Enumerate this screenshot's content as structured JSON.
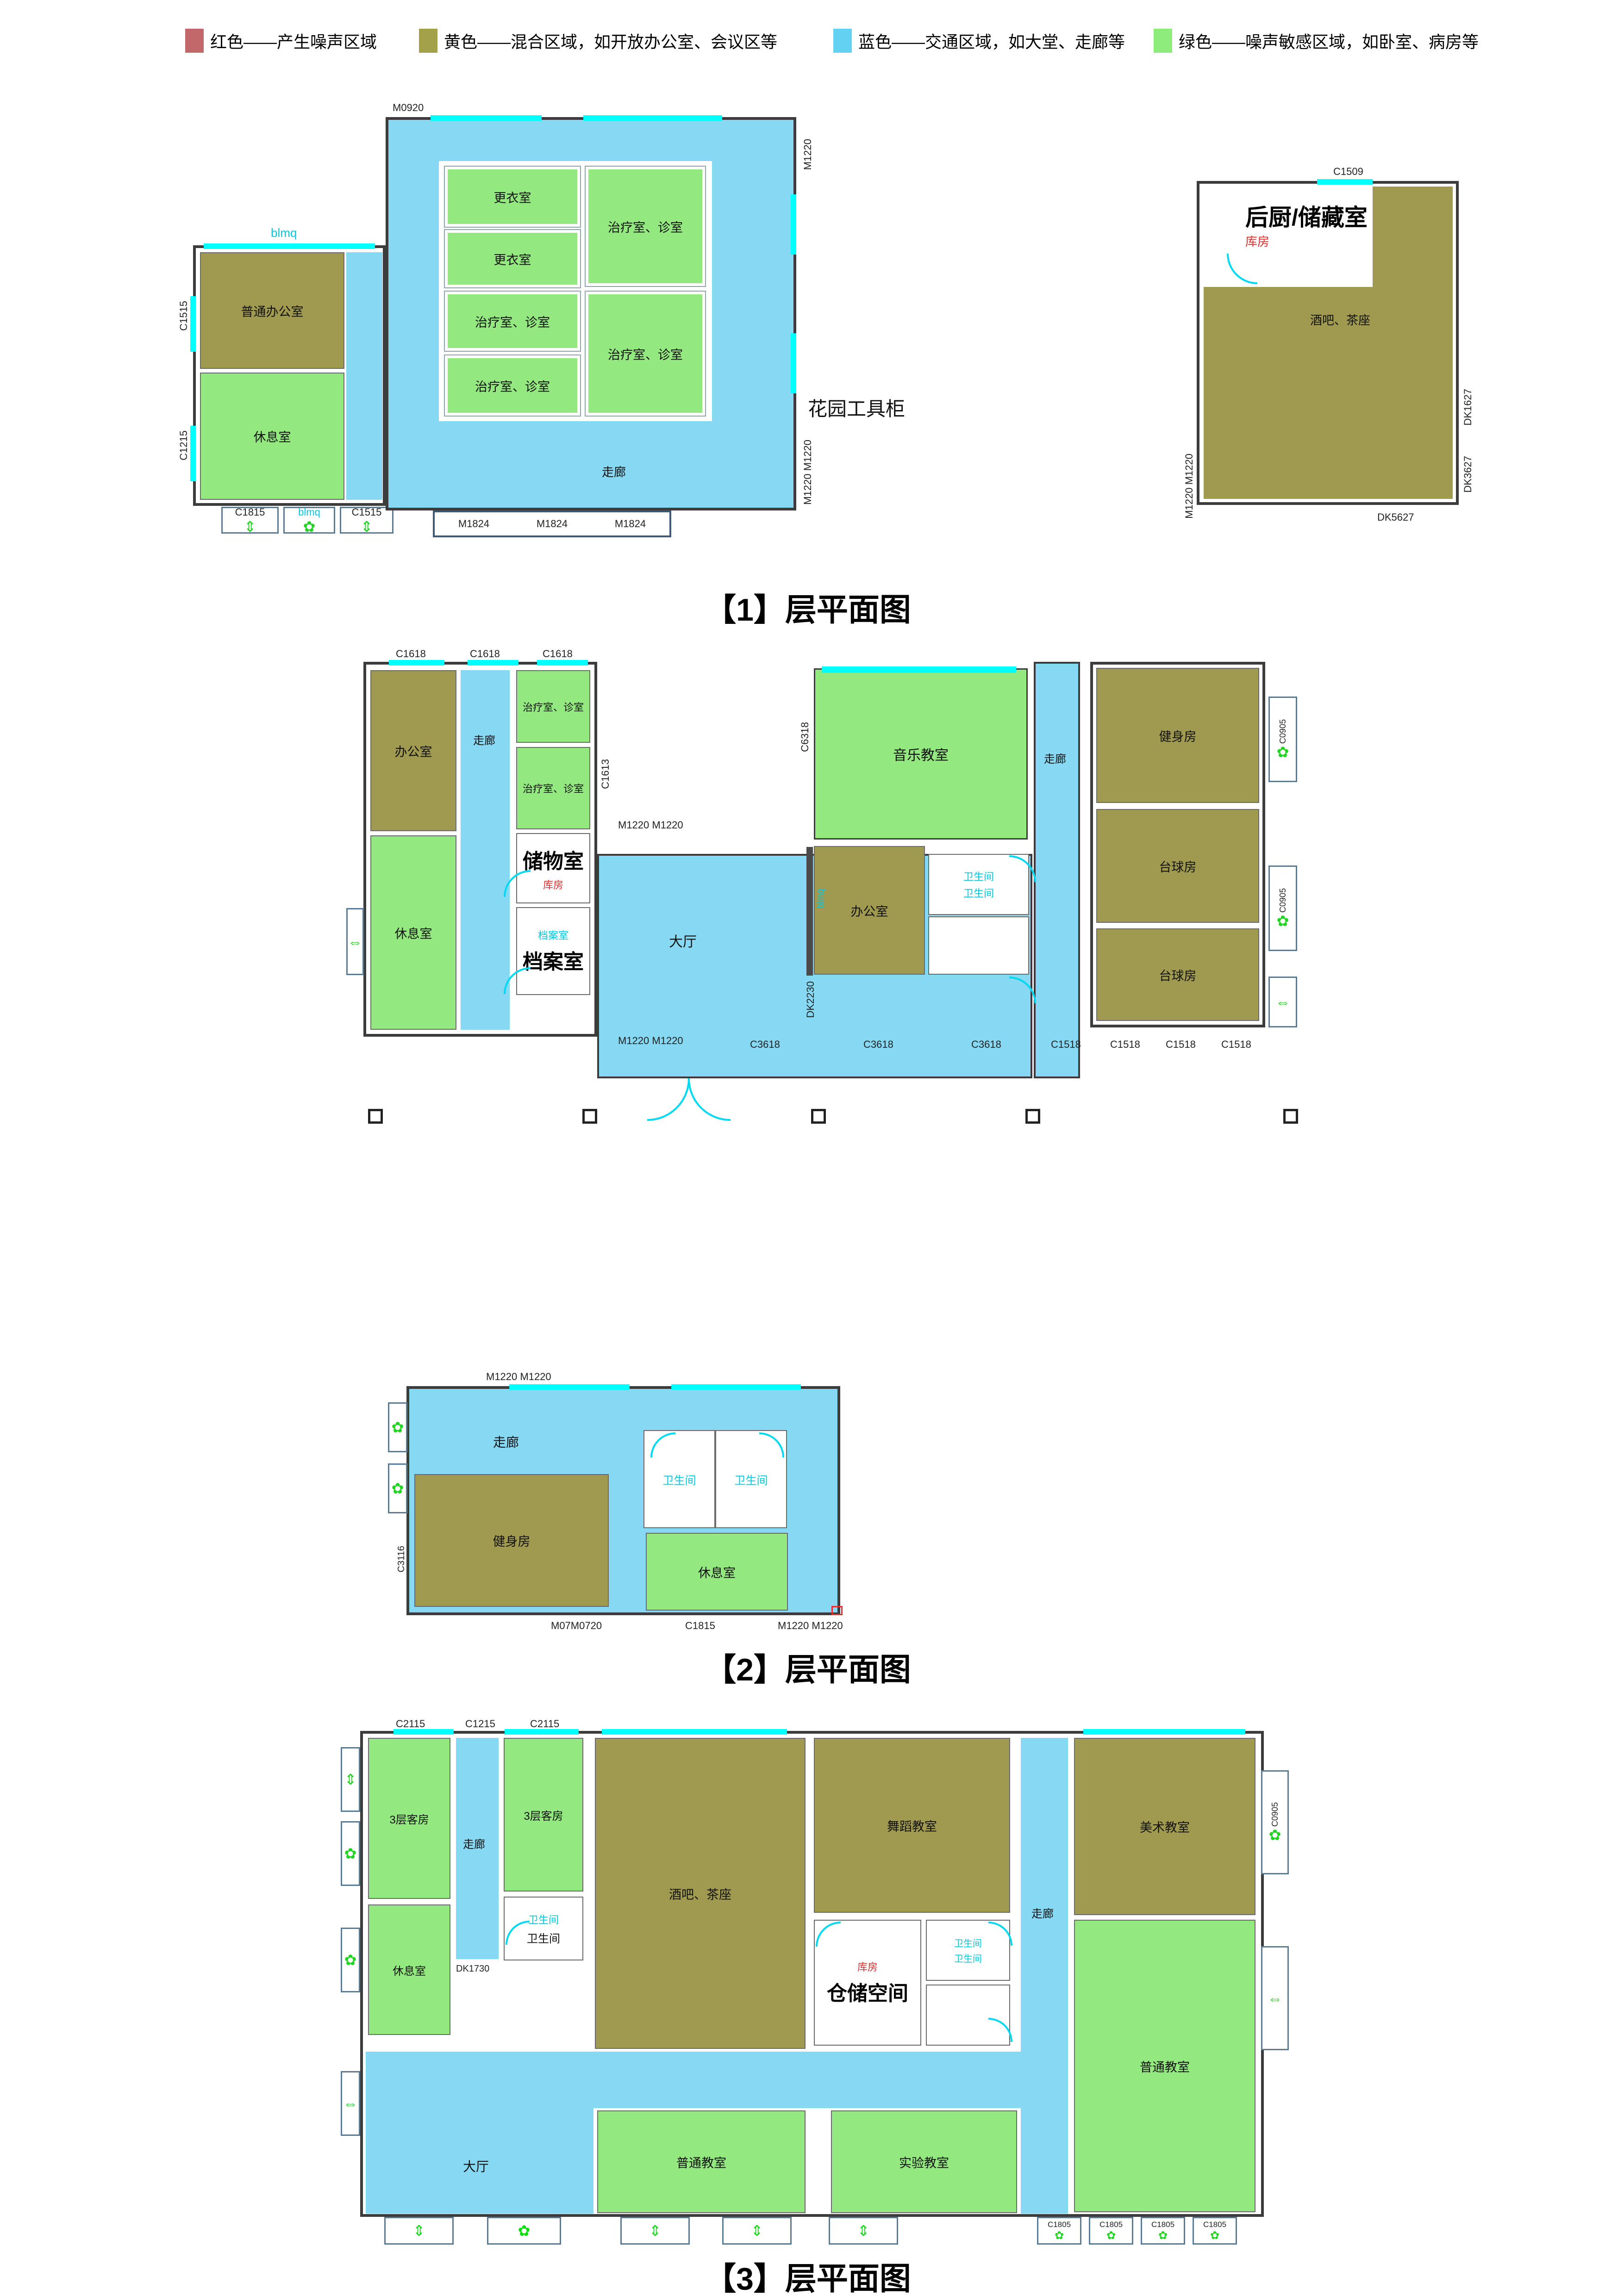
{
  "legend": {
    "items": [
      {
        "color": "#c2686b",
        "label": "红色——产生噪声区域"
      },
      {
        "color": "#a3a24a",
        "label": "黄色——混合区域，如开放办公室、会议区等"
      },
      {
        "color": "#63d2f2",
        "label": "蓝色——交通区域，如大堂、走廊等"
      },
      {
        "color": "#8dec7c",
        "label": "绿色——噪声敏感区域，如卧室、病房等"
      }
    ]
  },
  "captions": {
    "floor1": "【1】层平面图",
    "floor2": "【2】层平面图",
    "floor3": "【3】层平面图"
  },
  "rooms": {
    "office_general": "普通办公室",
    "rest": "休息室",
    "changing": "更衣室",
    "treatment": "治疗室、诊室",
    "corridor": "走廊",
    "office": "办公室",
    "storage": "储物室",
    "archive": "档案室",
    "music": "音乐教室",
    "toilet": "卫生间",
    "lobby": "大厅",
    "gym": "健身房",
    "billiard": "台球房",
    "kitchen": "后厨/储藏室",
    "bar": "酒吧、茶座",
    "guest3f": "3层客房",
    "dance": "舞蹈教室",
    "warehouse": "仓储空间",
    "art": "美术教室",
    "classroom": "普通教室",
    "lab": "实验教室",
    "kufang_red": "库房",
    "garden_note": "花园工具柜"
  },
  "marks": {
    "m0920": "M0920",
    "m1220": "M1220",
    "m1220x2": "M1220 M1220",
    "m1824": "M1824",
    "c1509": "C1509",
    "dk1627": "DK1627",
    "dk3627": "DK3627",
    "dk5627": "DK5627",
    "c1515": "C1515",
    "c1215": "C1215",
    "c1815": "C1815",
    "blmq": "blmq",
    "c1618": "C1618",
    "c1613": "C1613",
    "c6318": "C6318",
    "c3618": "C3618",
    "c1518": "C1518",
    "c0905": "C0905",
    "dk2230": "DK2230",
    "c3116": "C3116",
    "m07m0720": "M07M0720",
    "c2115": "C2115",
    "dk1730": "DK1730",
    "c1805": "C1805"
  },
  "icons": {
    "flower": "✿",
    "varrow": "⇕",
    "harrow": "⇔"
  }
}
